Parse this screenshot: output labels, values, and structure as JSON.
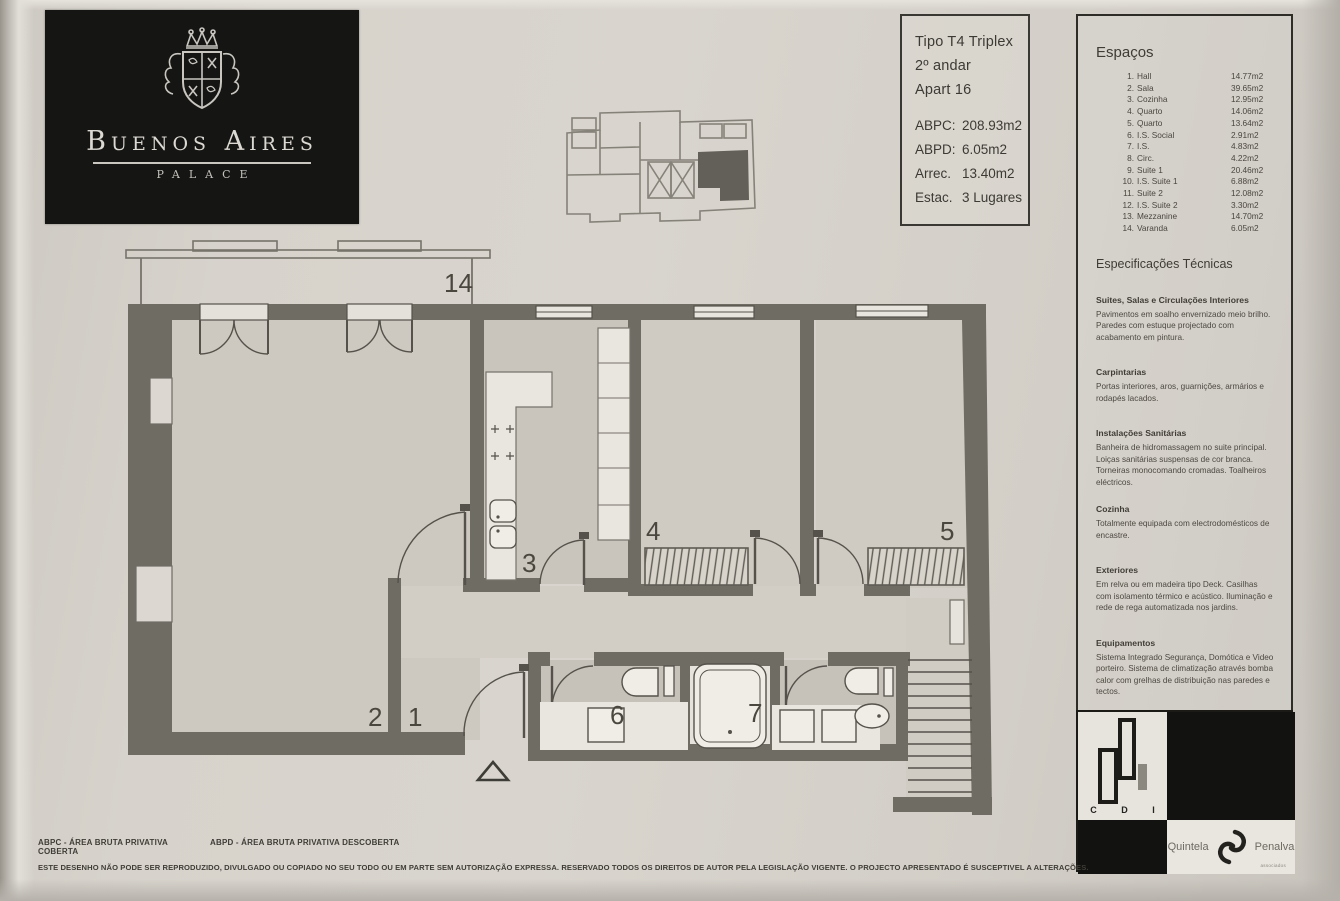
{
  "brand": {
    "name": "Buenos Aires",
    "sub": "PALACE"
  },
  "info_box": {
    "line1": "Tipo T4 Triplex",
    "line2": "2º andar",
    "line3": "Apart 16",
    "rows": [
      {
        "label": "ABPC:",
        "value": "208.93m2"
      },
      {
        "label": "ABPD:",
        "value": "6.05m2"
      },
      {
        "label": "Arrec.",
        "value": "13.40m2"
      },
      {
        "label": "Estac.",
        "value": "3 Lugares"
      }
    ]
  },
  "spaces": {
    "title": "Espaços",
    "items": [
      {
        "num": "1.",
        "name": "Hall",
        "area": "14.77m2"
      },
      {
        "num": "2.",
        "name": "Sala",
        "area": "39.65m2"
      },
      {
        "num": "3.",
        "name": "Cozinha",
        "area": "12.95m2"
      },
      {
        "num": "4.",
        "name": "Quarto",
        "area": "14.06m2"
      },
      {
        "num": "5.",
        "name": "Quarto",
        "area": "13.64m2"
      },
      {
        "num": "6.",
        "name": "I.S. Social",
        "area": "2.91m2"
      },
      {
        "num": "7.",
        "name": "I.S.",
        "area": "4.83m2"
      },
      {
        "num": "8.",
        "name": "Circ.",
        "area": "4.22m2"
      },
      {
        "num": "9.",
        "name": "Suite 1",
        "area": "20.46m2"
      },
      {
        "num": "10.",
        "name": "I.S. Suite 1",
        "area": "6.88m2"
      },
      {
        "num": "11.",
        "name": "Suite 2",
        "area": "12.08m2"
      },
      {
        "num": "12.",
        "name": "I.S. Suite 2",
        "area": "3.30m2"
      },
      {
        "num": "13.",
        "name": "Mezzanine",
        "area": "14.70m2"
      },
      {
        "num": "14.",
        "name": "Varanda",
        "area": "6.05m2"
      }
    ]
  },
  "specs": {
    "title": "Especificações Técnicas",
    "sections": [
      {
        "heading": "Suites, Salas e Circulações Interiores",
        "body": "Pavimentos em soalho envernizado meio brilho. Paredes com estuque projectado com acabamento em pintura."
      },
      {
        "heading": "Carpintarias",
        "body": "Portas interiores, aros, guarnições, armários e rodapés lacados."
      },
      {
        "heading": "Instalações Sanitárias",
        "body": "Banheira de hidromassagem no suite principal. Loiças sanitárias suspensas de cor branca. Torneiras monocomando cromadas. Toalheiros eléctricos."
      },
      {
        "heading": "Cozinha",
        "body": "Totalmente equipada com electrodomésticos de encastre."
      },
      {
        "heading": "Exteriores",
        "body": "Em relva ou em madeira tipo Deck. Casilhas com isolamento térmico e acústico. Iluminação e rede de rega automatizada nos jardins."
      },
      {
        "heading": "Equipamentos",
        "body": "Sistema Integrado Segurança, Domótica e Video porteiro. Sistema de climatização através bomba calor com grelhas de distribuição nas paredes e tectos."
      }
    ]
  },
  "plan": {
    "labels": {
      "varanda": "14",
      "sala": "2",
      "hall": "1",
      "cozinha": "3",
      "quarto4": "4",
      "quarto5": "5",
      "is6": "6",
      "is7": "7"
    },
    "colors": {
      "wall": "#6f6c64",
      "room": "#cdc9c1",
      "paper": "#d6d2ca"
    }
  },
  "footer": {
    "abpc": "ABPC - ÁREA BRUTA PRIVATIVA COBERTA",
    "abpd": "ABPD - ÁREA BRUTA PRIVATIVA DESCOBERTA",
    "legal": "ESTE DESENHO NÃO PODE SER REPRODUZIDO, DIVULGADO OU COPIADO NO SEU TODO OU EM PARTE SEM AUTORIZAÇÃO EXPRESSA. RESERVADO TODOS OS DIREITOS DE AUTOR PELA LEGISLAÇÃO VIGENTE. O PROJECTO APRESENTADO É SUSCEPTIVEL A ALTERAÇÕES."
  },
  "cdi": {
    "c": "C",
    "d": "D",
    "i": "I"
  },
  "agency": {
    "name1": "Quintela",
    "name2": "Penalva",
    "sub": "associados"
  }
}
